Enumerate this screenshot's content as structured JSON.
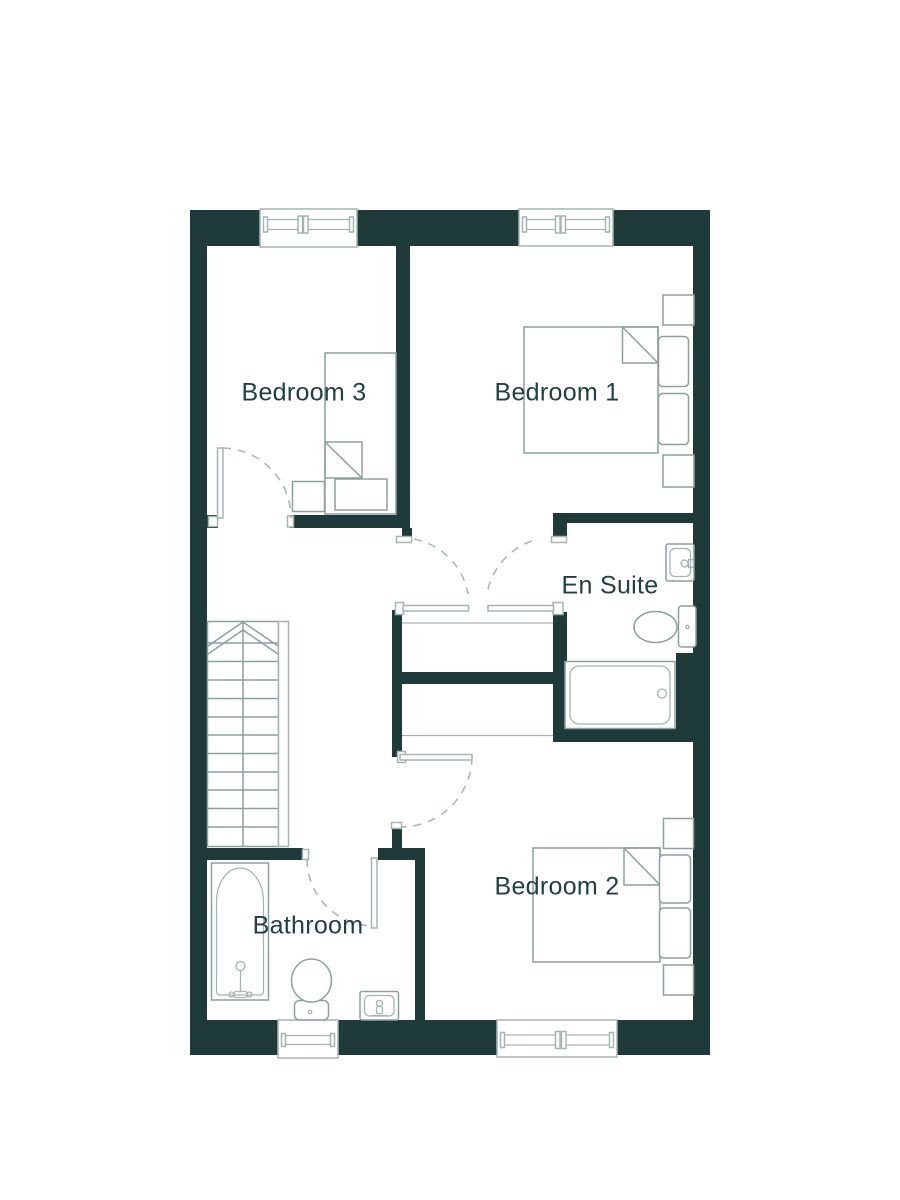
{
  "colors": {
    "wall": "#1f3b39",
    "line": "#8ba19e",
    "line_light": "#a3b5b2",
    "arc": "#a8b9b6",
    "text": "#21403e",
    "floor": "#ffffff"
  },
  "rooms": [
    {
      "id": "bedroom3",
      "label": "Bedroom 3"
    },
    {
      "id": "bedroom1",
      "label": "Bedroom 1"
    },
    {
      "id": "en_suite",
      "label": "En Suite"
    },
    {
      "id": "bathroom",
      "label": "Bathroom"
    },
    {
      "id": "bedroom2",
      "label": "Bedroom 2"
    }
  ]
}
